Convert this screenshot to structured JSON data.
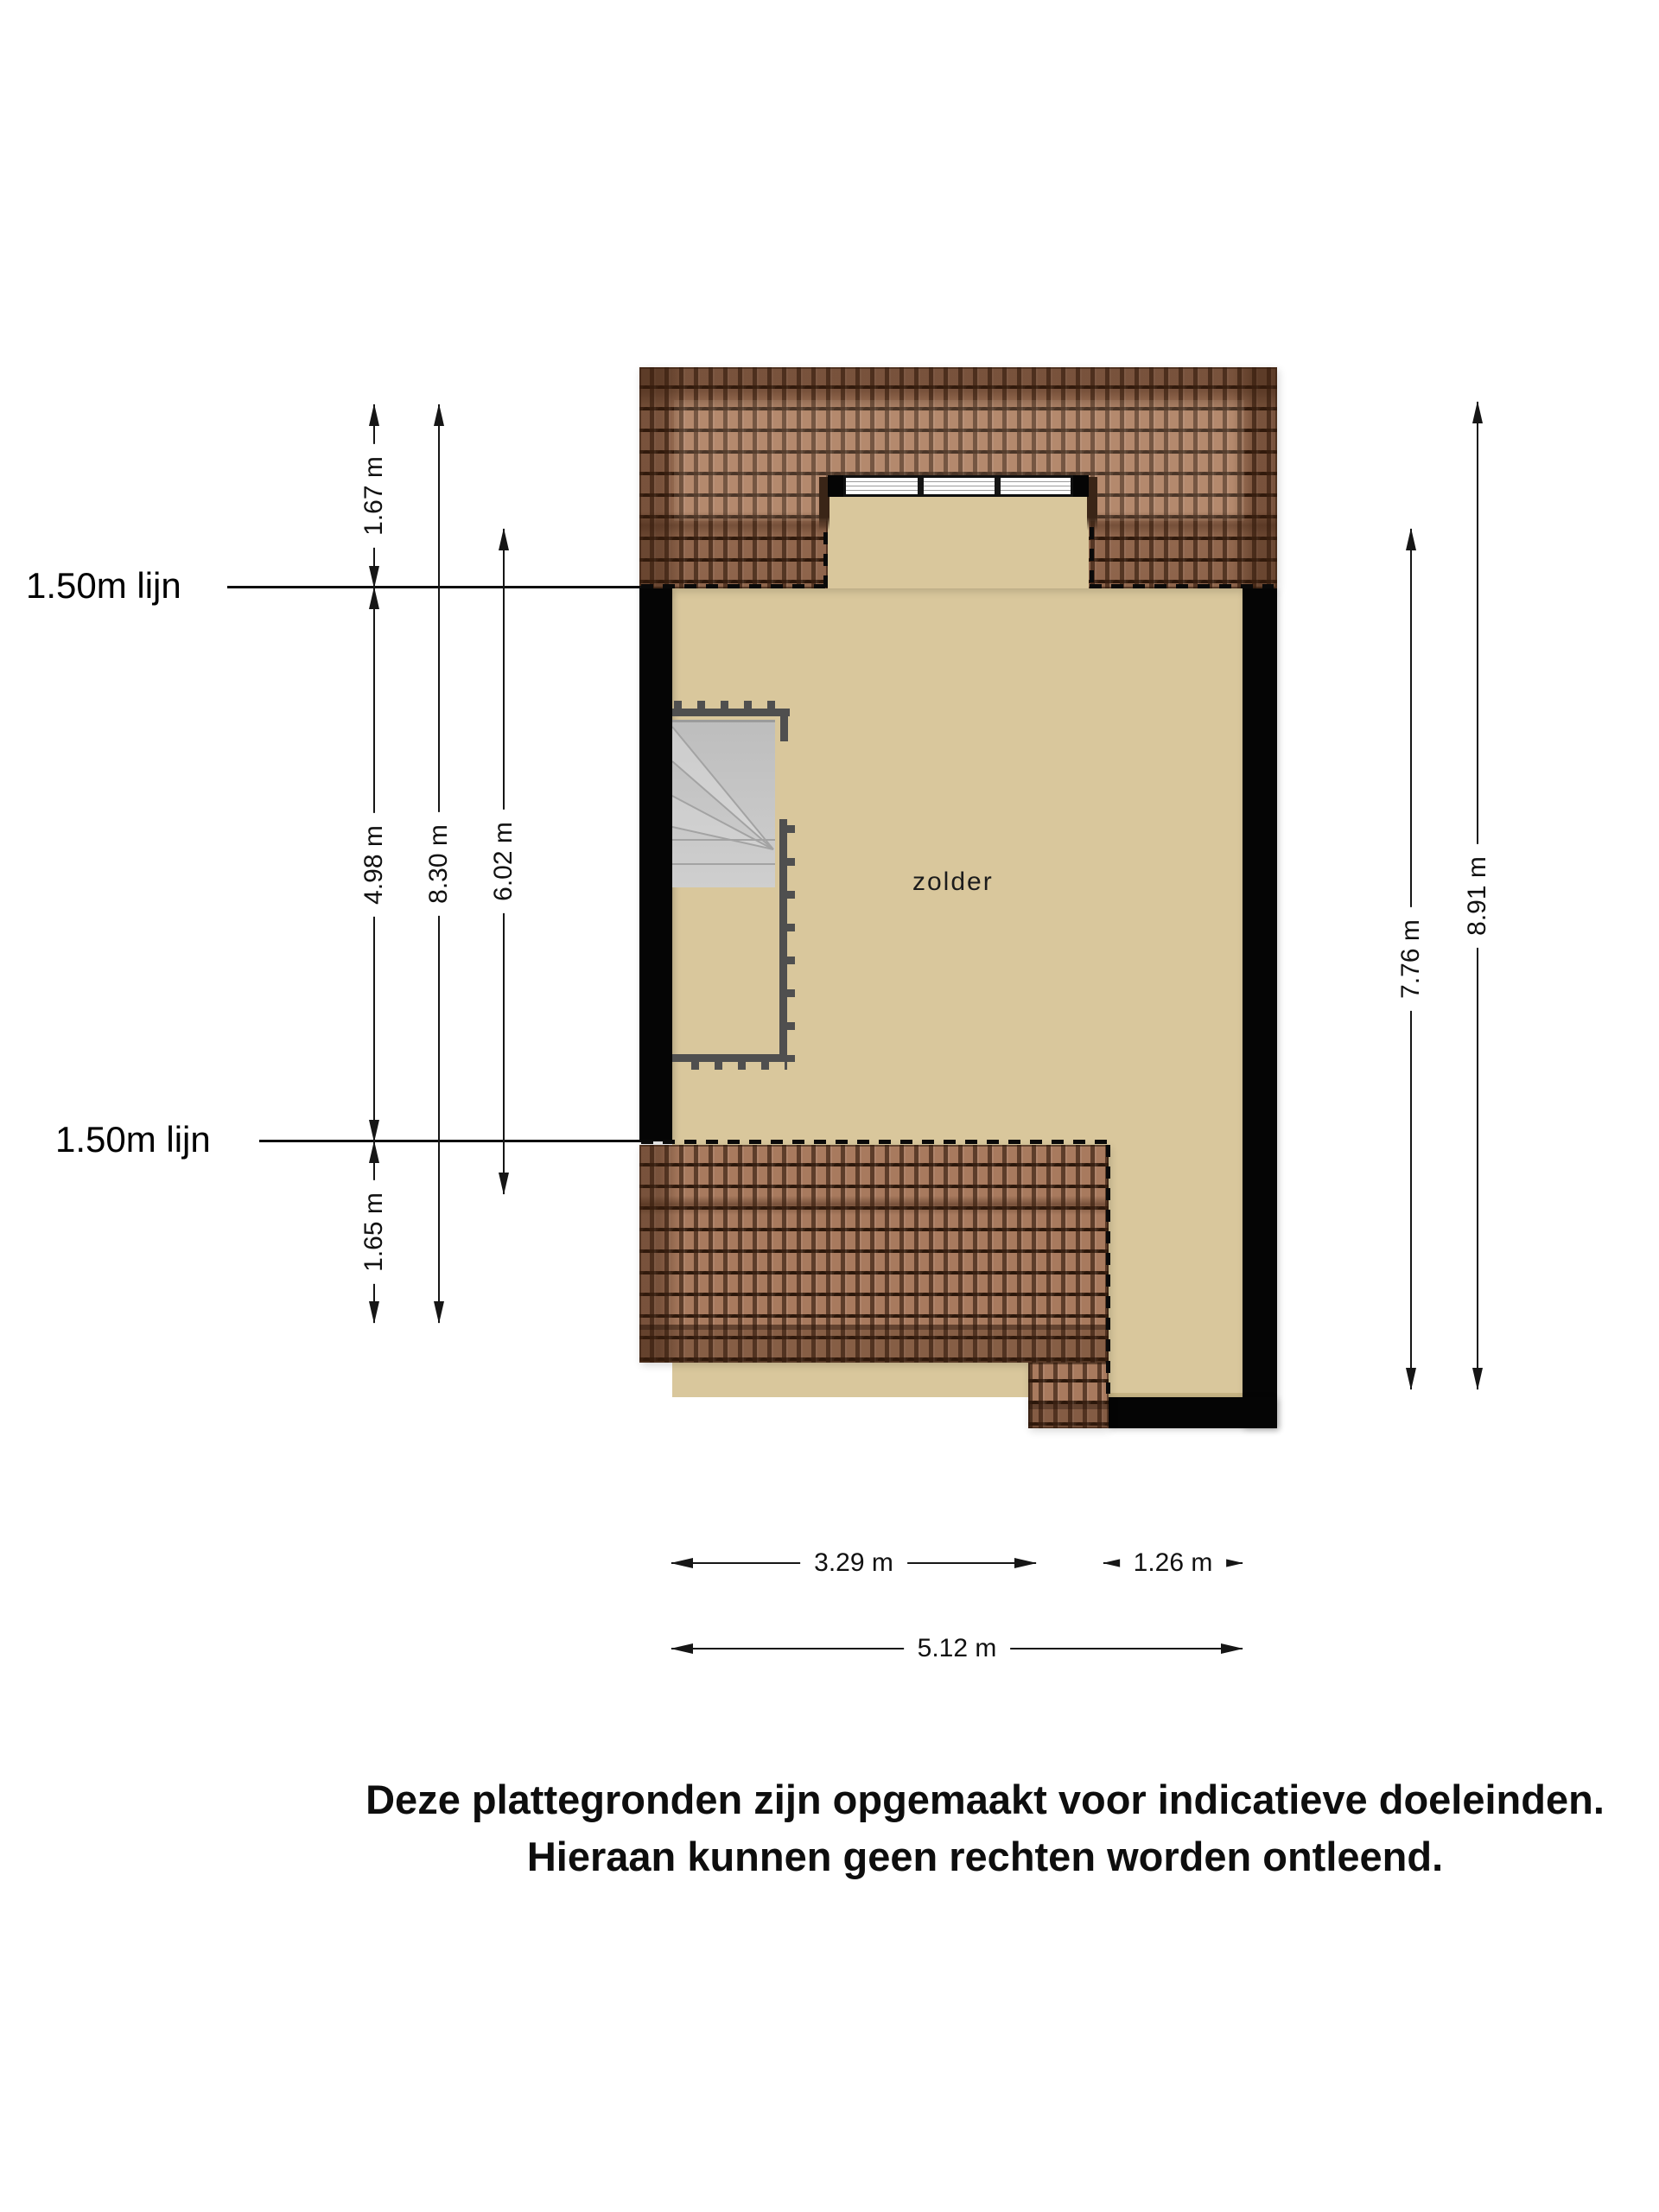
{
  "plan": {
    "room_label": "zolder",
    "line150_top_label": "1.50m lijn",
    "line150_bottom_label": "1.50m lijn"
  },
  "dimensions": {
    "left_roof_top": "1.67 m",
    "left_room": "4.98 m",
    "left_roof_bottom": "1.65 m",
    "left_total": "8.30 m",
    "left_inner": "6.02 m",
    "right_inner": "7.76 m",
    "right_total": "8.91 m",
    "bottom_left_part": "3.29 m",
    "bottom_right_part": "1.26 m",
    "bottom_total": "5.12 m"
  },
  "window": {
    "panes": 3
  },
  "disclaimer": {
    "line1": "Deze plattegronden zijn opgemaakt voor indicatieve doeleinden.",
    "line2": "Hieraan kunnen geen rechten worden ontleend."
  },
  "colors": {
    "floor": "#d9c79c",
    "roof_tile": "#a87a5e",
    "roof_line": "#2a160a",
    "wall": "#050505",
    "stairs": "#c9c9c9",
    "railing": "#4f4f4f",
    "dimension_line": "#161616",
    "background": "#ffffff"
  }
}
